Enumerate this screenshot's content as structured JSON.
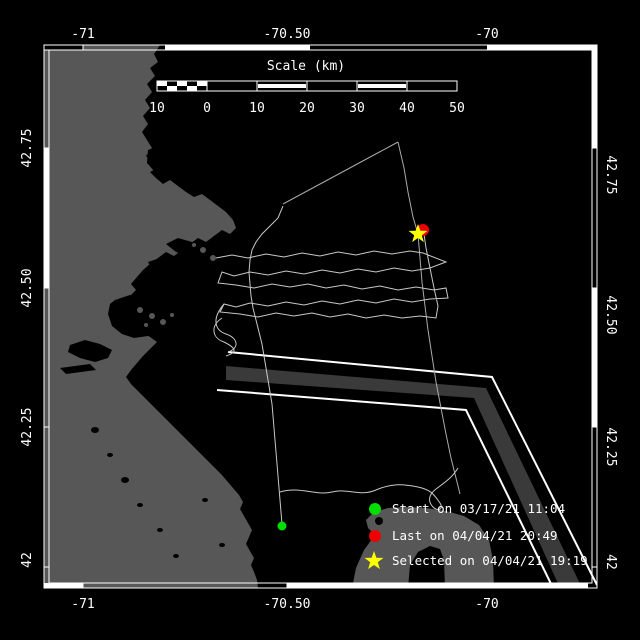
{
  "figure": {
    "background": "#000000",
    "frame_color": "#ffffff"
  },
  "map": {
    "land_color": "#575757",
    "sea_color": "#000000",
    "lane_fill": "#3a3a3a",
    "lane_line_color": "#ffffff",
    "track_color": "#aaaaaa",
    "drift_color": "#c8c8c8"
  },
  "axes": {
    "lon_top": [
      "-71",
      "-70.50",
      "-70"
    ],
    "lon_bottom": [
      "-71",
      "-70.50",
      "-70"
    ],
    "lat_left": [
      "42.75",
      "42.50",
      "42.25",
      "42"
    ],
    "lat_right": [
      "42.75",
      "42.50",
      "42.25",
      "42"
    ]
  },
  "scale_bar": {
    "title": "Scale (km)",
    "tick_labels": [
      "10",
      "0",
      "10",
      "20",
      "30",
      "40",
      "50"
    ]
  },
  "legend": {
    "items": [
      {
        "marker": "circle",
        "color": "#00dd00",
        "label": "Start on 03/17/21 11:04"
      },
      {
        "marker": "circle",
        "color": "#ee0000",
        "label": "Last on 04/04/21 20:49"
      },
      {
        "marker": "star",
        "color": "#ffff00",
        "label": "Selected on 04/04/21 19:19"
      }
    ]
  },
  "markers": {
    "start": {
      "x": 282,
      "y": 526,
      "color": "#00dd00"
    },
    "last": {
      "x": 423,
      "y": 230,
      "color": "#ee0000"
    },
    "selected": {
      "x": 418,
      "y": 234,
      "color": "#ffff00"
    }
  }
}
